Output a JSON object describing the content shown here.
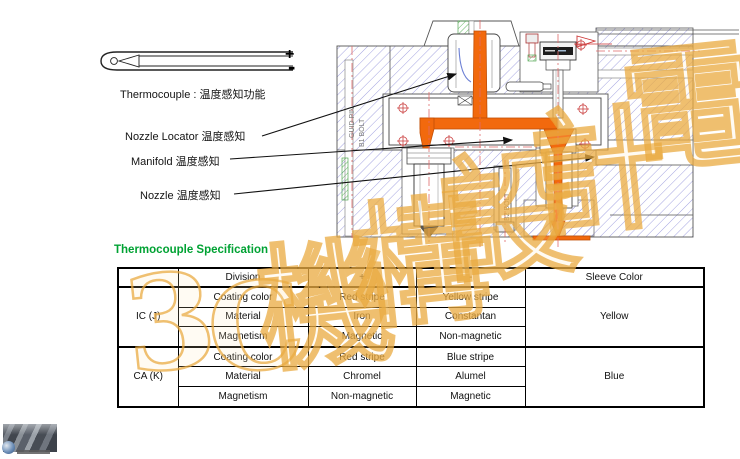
{
  "probe": {
    "plus_label": "+",
    "minus_label": "-"
  },
  "labels": {
    "thermocouple": {
      "en": "Thermocouple :",
      "zh": "温度感知功能"
    },
    "nozzle_locator": {
      "en": "Nozzle Locator",
      "zh": "温度感知"
    },
    "manifold": {
      "en": "Manifold",
      "zh": "温度感知"
    },
    "nozzle": {
      "en": "Nozzle",
      "zh": "温度感知"
    }
  },
  "drawing": {
    "annotations": {
      "guid_pin": "GUID PIN",
      "b1_bolt": "B1 BOLT",
      "b2_bolt": "B2 BOLT"
    }
  },
  "section_title": "Thermocouple Specification",
  "table": {
    "headers": [
      "",
      "Division",
      "+",
      "-",
      "Sleeve Color"
    ],
    "groups": [
      {
        "name": "IC (J)",
        "sleeve_color": "Yellow",
        "rows": [
          {
            "division": "Coating color",
            "plus": "Red stripe",
            "minus": "Yellow stripe"
          },
          {
            "division": "Material",
            "plus": "Iron",
            "minus": "Constantan"
          },
          {
            "division": "Magnetism",
            "plus": "Magnetic",
            "minus": "Non-magnetic"
          }
        ]
      },
      {
        "name": "CA (K)",
        "sleeve_color": "Blue",
        "rows": [
          {
            "division": "Coating color",
            "plus": "Red stripe",
            "minus": "Blue stripe"
          },
          {
            "division": "Material",
            "plus": "Chromel",
            "minus": "Alumel"
          },
          {
            "division": "Magnetism",
            "plus": "Non-magnetic",
            "minus": "Magnetic"
          }
        ]
      }
    ]
  },
  "watermark": {
    "chars": [
      "3",
      "C",
      "機",
      "構",
      "設",
      "計",
      "電"
    ],
    "color": "#E8A83C"
  },
  "colors": {
    "title_green": "#00A233",
    "runner_orange": "#F2690D",
    "hatch_blue": "#9A9ADE",
    "hatch_green": "#57B157",
    "centerline_red": "#E06A6A"
  }
}
